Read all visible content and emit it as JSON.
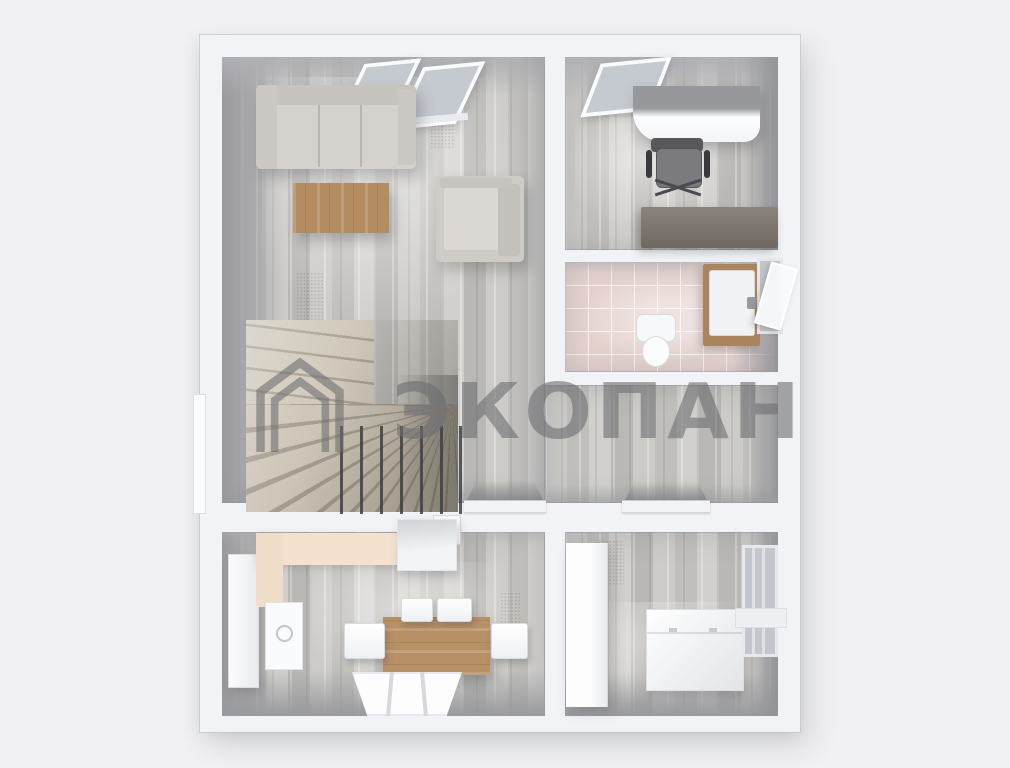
{
  "watermark": {
    "text": "ЭКОПАН",
    "logo": "house-outline-logo",
    "color": "#6e6e72"
  },
  "palette": {
    "background": "#f1f1f3",
    "wall": "#f2f3f6",
    "wood_floor": "#c8c7c3",
    "stair_wood": "#c6beb0",
    "bathroom_tile": "#e6d3d0",
    "kitchen_counter": "#f4e2cf",
    "table_wood": "#b48c62",
    "sofa_gray": "#d5d2ce",
    "office_cabinet": "#7d766f"
  },
  "scene": {
    "type": "3d-floorplan-top-down-render",
    "rooms": [
      {
        "name": "living-room",
        "position": "top-left",
        "furniture": [
          "corner-sofa",
          "coffee-table",
          "armchair",
          "winder-staircase",
          "stair-railing",
          "double-skylight-window"
        ]
      },
      {
        "name": "office",
        "position": "top-right",
        "furniture": [
          "curved-desk",
          "office-chair",
          "low-cabinet",
          "window"
        ]
      },
      {
        "name": "bathroom",
        "position": "middle-right",
        "furniture": [
          "toilet",
          "vanity-sink",
          "open-window"
        ]
      },
      {
        "name": "hallway",
        "position": "center",
        "furniture": [
          "doorway-left",
          "doorway-right"
        ]
      },
      {
        "name": "kitchen-dining",
        "position": "bottom-left",
        "furniture": [
          "tall-fridge",
          "l-shaped-counter",
          "sink-unit",
          "wall-cabinet",
          "dining-table",
          "chair-top-1",
          "chair-top-2",
          "chair-left",
          "chair-right",
          "bottom-window"
        ]
      },
      {
        "name": "bedroom",
        "position": "bottom-right",
        "furniture": [
          "wardrobe",
          "storage-chest",
          "window",
          "window-sill"
        ]
      }
    ]
  }
}
